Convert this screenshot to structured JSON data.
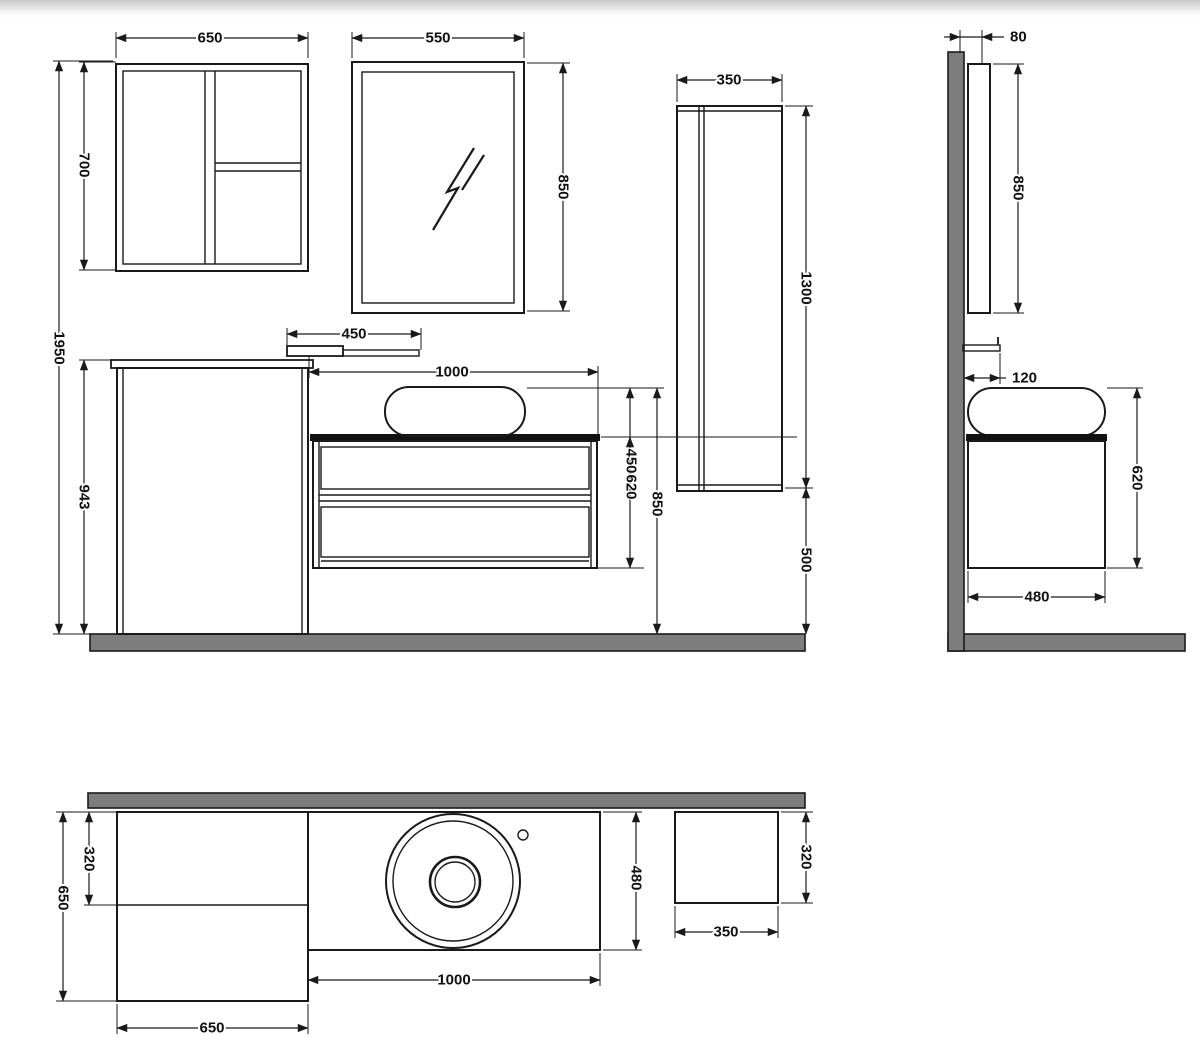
{
  "labels": {
    "front": {
      "wall_cab_width": "650",
      "mirror_width": "550",
      "wall_cab_height": "700",
      "overall_height": "1950",
      "base_cab_height": "943",
      "shelf_width": "450",
      "vanity_width": "1000",
      "mirror_height": "850",
      "vanity_cab_height": "450",
      "basin_to_cab_bottom": "620",
      "basin_top_height": "850",
      "tall_cab_width": "350",
      "tall_cab_height": "1300",
      "tall_cab_clearance": "500"
    },
    "side": {
      "mirror_depth": "80",
      "mirror_height": "850",
      "shelf_depth": "120",
      "vanity_height": "620",
      "vanity_depth": "480"
    },
    "plan": {
      "base_cab_depth": "650",
      "wall_cab_depth": "320",
      "base_cab_width": "650",
      "vanity_width": "1000",
      "vanity_depth": "480",
      "tall_cab_width": "350",
      "tall_cab_depth": "320"
    }
  },
  "colors": {
    "line": "#1a1a1a",
    "surface": "#7d7d7d",
    "counter": "#111111",
    "background": "#ffffff"
  }
}
